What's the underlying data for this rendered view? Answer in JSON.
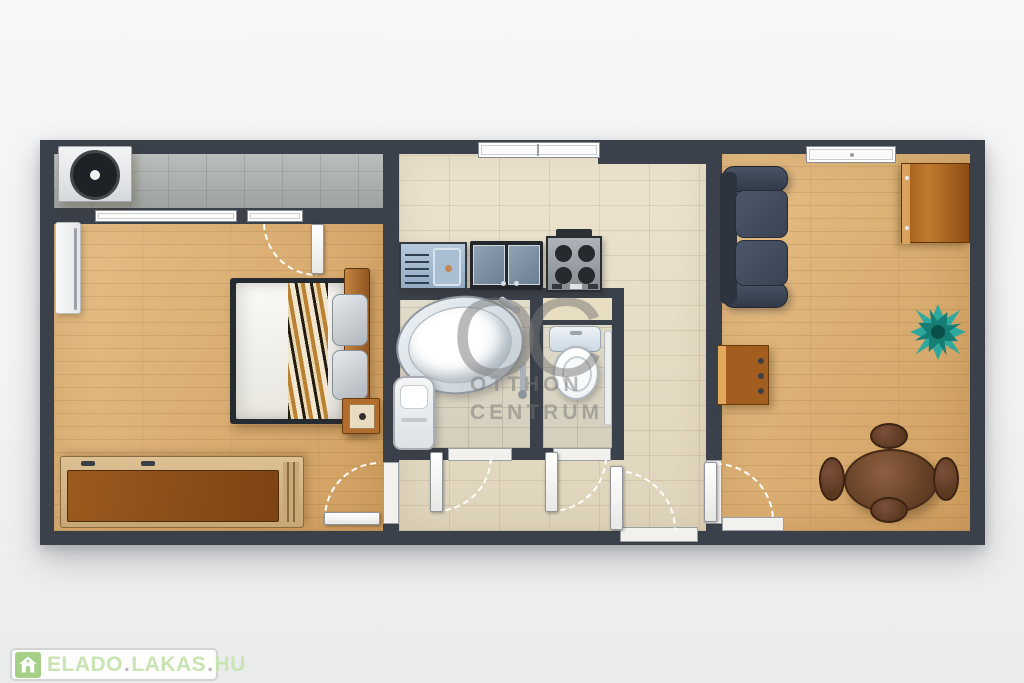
{
  "image": {
    "type": "apartment-floor-plan-render",
    "view": "top-down-3d"
  },
  "watermark": {
    "monogram": "OC",
    "line1": "OTTHON",
    "line2": "CENTRUM"
  },
  "logo": {
    "word1": "ELADO",
    "word2": "LAKAS",
    "word3": "HU",
    "dot": "."
  },
  "colors": {
    "wall": "#3b414a",
    "wood": "#dfb379",
    "tile_gray": "#adb2b0",
    "tile_beige": "#e8e0ca",
    "tile_bath": "#ded8c6",
    "sofa": "#3f4857",
    "wood_furn": "#a35d1f",
    "table_brown": "#6a452c",
    "plant_teal": "#2fa89e",
    "watermark": "rgba(118,118,118,0.5)",
    "logo_green": "#a6cf87",
    "logo_text": "#c9e4b2",
    "logo_dot": "#b4b8b4",
    "logo_border": "#d2d5d2"
  },
  "plan": {
    "rooms": [
      {
        "name": "bedroom",
        "floor": "wood",
        "furniture": [
          "air-conditioner",
          "balcony-tiles",
          "radiator",
          "double-bed",
          "zebra-runner",
          "pillows",
          "headboard",
          "nightstand",
          "wardrobe"
        ]
      },
      {
        "name": "kitchen-bathroom-hall",
        "floor": "beige-tile",
        "furniture": [
          "kitchen-sink",
          "glass-cabinet",
          "stove",
          "bathtub",
          "bath-cabinet",
          "towel-rail",
          "toilet",
          "wc-pipe",
          "entry-door"
        ]
      },
      {
        "name": "living-room",
        "floor": "wood",
        "furniture": [
          "sofa",
          "corner-desk",
          "dresser",
          "plant",
          "oval-dining-table",
          "four-chairs"
        ]
      }
    ]
  }
}
